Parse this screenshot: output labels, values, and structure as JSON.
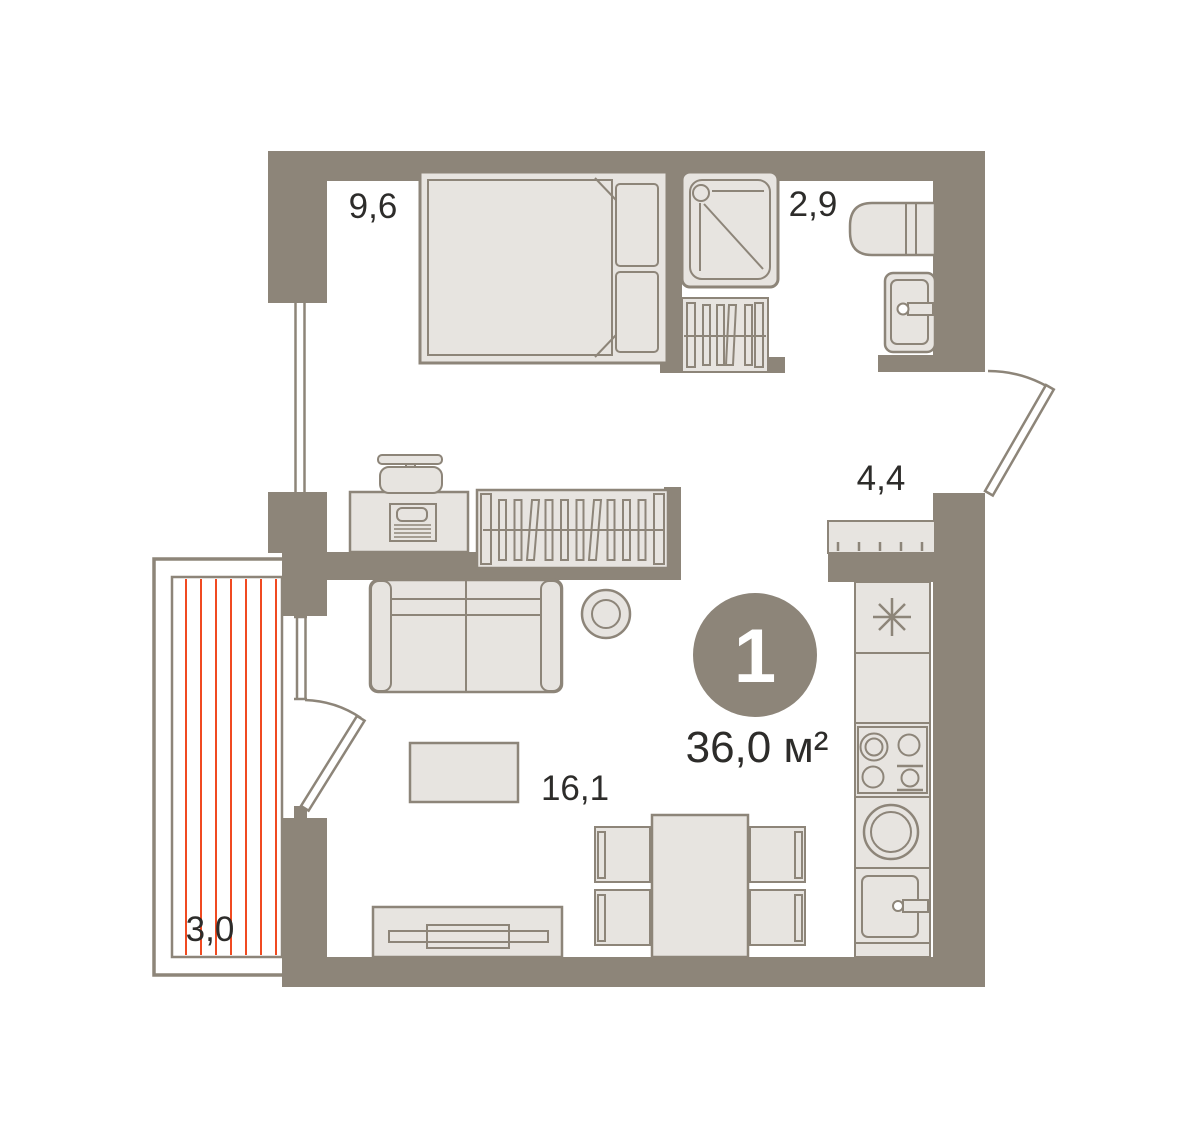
{
  "plan": {
    "unit_badge": {
      "rooms_count": "1",
      "total_area": "36,0 м²"
    },
    "rooms": {
      "bedroom": {
        "area": "9,6"
      },
      "bathroom": {
        "area": "2,9"
      },
      "hallway": {
        "area": "4,4"
      },
      "living_room": {
        "area": "16,1"
      },
      "balcony": {
        "area": "3,0"
      }
    },
    "colors": {
      "wall": "#8d8579",
      "furniture_fill": "#e7e4e0",
      "outline": "#8d8579",
      "balcony_stripe": "#f04a21",
      "text": "#2d2c2a",
      "badge_fill": "#8d8579",
      "badge_text": "#ffffff",
      "background": "#ffffff"
    }
  }
}
